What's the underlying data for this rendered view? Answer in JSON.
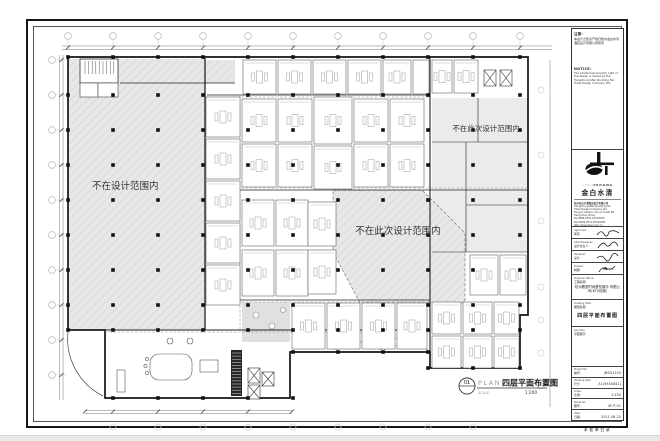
{
  "plan": {
    "zone_left_label": "不在设计范围内",
    "zone_center_label": "不在此次设计范围内",
    "zone_topright_label": "不在此次设计范围内",
    "mark": {
      "number": "01",
      "plan_word": "PLAN",
      "title": "四层平面布置图",
      "scale_word": "SCALE",
      "scale_value": "1:200"
    }
  },
  "title_block": {
    "notice": {
      "heading_cn": "注意:",
      "body_cn": "本设计之知识产权归杭州金白水清酒店设计有限公司所有",
      "heading_en": "NOTICE:",
      "body_en": "The intellectual property right of the design is owned by the Hangzhou JinBai ShuiQing Fan Hotel Design Company Ltd."
    },
    "brand": {
      "en_light": "JINBAI",
      "en_dark": "SHUIQING",
      "cn": "金白水清"
    },
    "company": {
      "line1": "杭州金白水清酒店设计有限公司",
      "line2": "Hangzhou JinBai ShuiQing Fan",
      "line3": "Hotel Design Company Ltd.",
      "line4": "Tong Jin Square, Yan an South Rd.",
      "line5": "Hang zhou China",
      "line6": "Tel:0086-0571-87619185",
      "line7": "Fax:0086-0571-87619181",
      "line8": "http://www.jbsq.com.cn"
    },
    "signatures": [
      {
        "label_en": "Approved:",
        "label_cn": "审定:"
      },
      {
        "label_en": "Chief Designer:",
        "label_cn": "设计负责人:"
      },
      {
        "label_en": "Designer:",
        "label_cn": "设计:"
      },
      {
        "label_en": "Drawer:",
        "label_cn": "制图:"
      }
    ],
    "engineer": {
      "label_en": "Engineer Name:",
      "label_cn": "工程名称:",
      "value": "杭州殿堂时尚餐饮娱乐 有限公司(KTV包厢)"
    },
    "drawing_title": {
      "label_en": "Drawing Title:",
      "label_cn": "图纸名称:",
      "value": "四层平面布置图"
    },
    "key_plan": {
      "label_en": "Key Plan:",
      "label_cn": "平面图示:"
    },
    "meta": [
      {
        "label_en": "Project No:",
        "label_cn": "编号:",
        "value": "JBSQ1103"
      },
      {
        "label_en": "Drawing Size:",
        "label_cn": "尺寸:",
        "value": "A1(594X841)"
      },
      {
        "label_en": "Scale:",
        "label_cn": "比例:",
        "value": "1:200"
      },
      {
        "label_en": "Sheet No:",
        "label_cn": "图号:",
        "value": "4F-P-01"
      },
      {
        "label_en": "Date:",
        "label_cn": "日期:",
        "value": "2011.06.25"
      }
    ],
    "footer_caption": "本套单目录"
  }
}
